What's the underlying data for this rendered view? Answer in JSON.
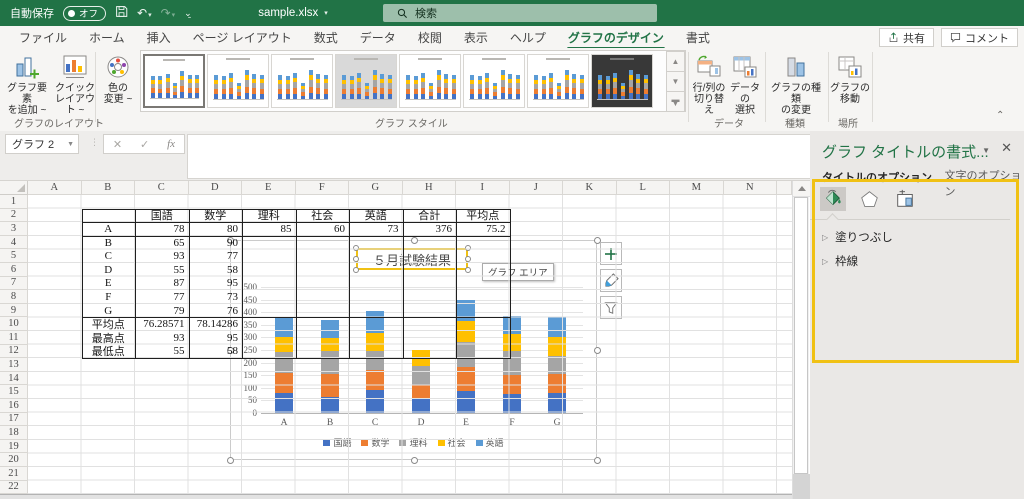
{
  "titlebar": {
    "autosave_label": "自動保存",
    "autosave_state": "オフ",
    "filename": "sample.xlsx",
    "search_label": "検索"
  },
  "tab_bar": {
    "tabs": [
      "ファイル",
      "ホーム",
      "挿入",
      "ページ レイアウト",
      "数式",
      "データ",
      "校閲",
      "表示",
      "ヘルプ",
      "グラフのデザイン",
      "書式"
    ],
    "active_tab": "グラフのデザイン",
    "share_label": "共有",
    "comment_label": "コメント"
  },
  "ribbon": {
    "buttons": {
      "add_element": {
        "l1": "グラフ要素",
        "l2": "を追加 ~"
      },
      "quick_layout": {
        "l1": "クイック",
        "l2": "レイアウト ~"
      },
      "change_colors": {
        "l1": "色の",
        "l2": "変更 ~"
      },
      "switch_rc": {
        "l1": "行/列の",
        "l2": "切り替え"
      },
      "select_data": {
        "l1": "データの",
        "l2": "選択"
      },
      "change_type": {
        "l1": "グラフの種類",
        "l2": "の変更"
      },
      "move_chart": {
        "l1": "グラフの",
        "l2": "移動"
      }
    },
    "group_labels": {
      "layout": "グラフのレイアウト",
      "styles": "グラフ スタイル",
      "data": "データ",
      "type": "種類",
      "location": "場所"
    },
    "style_thumbnails": [
      {
        "name": "style-1",
        "variant": "white",
        "selected": true
      },
      {
        "name": "style-2",
        "variant": "white",
        "selected": false
      },
      {
        "name": "style-3",
        "variant": "white",
        "selected": false
      },
      {
        "name": "style-4",
        "variant": "gray",
        "selected": false
      },
      {
        "name": "style-5",
        "variant": "white",
        "selected": false
      },
      {
        "name": "style-6",
        "variant": "white",
        "selected": false
      },
      {
        "name": "style-7",
        "variant": "white",
        "selected": false
      },
      {
        "name": "style-8",
        "variant": "dark",
        "selected": false
      }
    ]
  },
  "formula_bar": {
    "name_box": "グラフ 2"
  },
  "sheet": {
    "columns": [
      "A",
      "B",
      "C",
      "D",
      "E",
      "F",
      "G",
      "H",
      "I",
      "J",
      "K",
      "L",
      "M",
      "N"
    ],
    "row_count": 22,
    "cells": [
      {
        "r": 2,
        "c": "C",
        "v": "国語",
        "a": "c"
      },
      {
        "r": 2,
        "c": "D",
        "v": "数学",
        "a": "c"
      },
      {
        "r": 2,
        "c": "E",
        "v": "理科",
        "a": "c"
      },
      {
        "r": 2,
        "c": "F",
        "v": "社会",
        "a": "c"
      },
      {
        "r": 2,
        "c": "G",
        "v": "英語",
        "a": "c"
      },
      {
        "r": 2,
        "c": "H",
        "v": "合計",
        "a": "c"
      },
      {
        "r": 2,
        "c": "I",
        "v": "平均点",
        "a": "c"
      },
      {
        "r": 3,
        "c": "B",
        "v": "A",
        "a": "c"
      },
      {
        "r": 3,
        "c": "C",
        "v": "78",
        "a": "r"
      },
      {
        "r": 3,
        "c": "D",
        "v": "80",
        "a": "r"
      },
      {
        "r": 3,
        "c": "E",
        "v": "85",
        "a": "r"
      },
      {
        "r": 3,
        "c": "F",
        "v": "60",
        "a": "r"
      },
      {
        "r": 3,
        "c": "G",
        "v": "73",
        "a": "r"
      },
      {
        "r": 3,
        "c": "H",
        "v": "376",
        "a": "r"
      },
      {
        "r": 3,
        "c": "I",
        "v": "75.2",
        "a": "r"
      },
      {
        "r": 4,
        "c": "B",
        "v": "B",
        "a": "c"
      },
      {
        "r": 4,
        "c": "C",
        "v": "65",
        "a": "r"
      },
      {
        "r": 4,
        "c": "D",
        "v": "90",
        "a": "r"
      },
      {
        "r": 5,
        "c": "B",
        "v": "C",
        "a": "c"
      },
      {
        "r": 5,
        "c": "C",
        "v": "93",
        "a": "r"
      },
      {
        "r": 5,
        "c": "D",
        "v": "77",
        "a": "r"
      },
      {
        "r": 6,
        "c": "B",
        "v": "D",
        "a": "c"
      },
      {
        "r": 6,
        "c": "C",
        "v": "55",
        "a": "r"
      },
      {
        "r": 6,
        "c": "D",
        "v": "58",
        "a": "r"
      },
      {
        "r": 7,
        "c": "B",
        "v": "E",
        "a": "c"
      },
      {
        "r": 7,
        "c": "C",
        "v": "87",
        "a": "r"
      },
      {
        "r": 7,
        "c": "D",
        "v": "95",
        "a": "r"
      },
      {
        "r": 8,
        "c": "B",
        "v": "F",
        "a": "c"
      },
      {
        "r": 8,
        "c": "C",
        "v": "77",
        "a": "r"
      },
      {
        "r": 8,
        "c": "D",
        "v": "73",
        "a": "r"
      },
      {
        "r": 9,
        "c": "B",
        "v": "G",
        "a": "c"
      },
      {
        "r": 9,
        "c": "C",
        "v": "79",
        "a": "r"
      },
      {
        "r": 9,
        "c": "D",
        "v": "76",
        "a": "r"
      },
      {
        "r": 10,
        "c": "B",
        "v": "平均点",
        "a": "c"
      },
      {
        "r": 10,
        "c": "C",
        "v": "76.28571",
        "a": "r"
      },
      {
        "r": 10,
        "c": "D",
        "v": "78.14286",
        "a": "r"
      },
      {
        "r": 11,
        "c": "B",
        "v": "最高点",
        "a": "c"
      },
      {
        "r": 11,
        "c": "C",
        "v": "93",
        "a": "r"
      },
      {
        "r": 11,
        "c": "D",
        "v": "95",
        "a": "r"
      },
      {
        "r": 12,
        "c": "B",
        "v": "最低点",
        "a": "c"
      },
      {
        "r": 12,
        "c": "C",
        "v": "55",
        "a": "r"
      },
      {
        "r": 12,
        "c": "D",
        "v": "58",
        "a": "r"
      }
    ]
  },
  "chart_data": {
    "type": "bar",
    "stacked": true,
    "title": "５月試験結果",
    "categories": [
      "A",
      "B",
      "C",
      "D",
      "E",
      "F",
      "G"
    ],
    "series": [
      {
        "name": "国語",
        "color": "#4472C4",
        "values": [
          78,
          65,
          93,
          55,
          87,
          77,
          79
        ]
      },
      {
        "name": "数学",
        "color": "#ED7D31",
        "values": [
          80,
          90,
          77,
          58,
          95,
          73,
          76
        ]
      },
      {
        "name": "理科",
        "color": "#A5A5A5",
        "values": [
          85,
          90,
          75,
          75,
          100,
          95,
          70
        ]
      },
      {
        "name": "社会",
        "color": "#FFC000",
        "values": [
          60,
          53,
          73,
          62,
          83,
          70,
          75
        ]
      },
      {
        "name": "英語",
        "color": "#5B9BD5",
        "values": [
          73,
          70,
          87,
          0,
          85,
          70,
          82
        ]
      }
    ],
    "ylim": [
      0,
      500
    ],
    "ytick_step": 50,
    "grid": true,
    "legend_position": "bottom",
    "tooltip": "グラフ エリア"
  },
  "format_pane": {
    "title": "グラフ タイトルの書式...",
    "tab_options": "タイトルのオプション",
    "tab_text": "文字のオプション",
    "sections": [
      "塗りつぶし",
      "枠線"
    ],
    "highlight_color": "#F0C114"
  }
}
